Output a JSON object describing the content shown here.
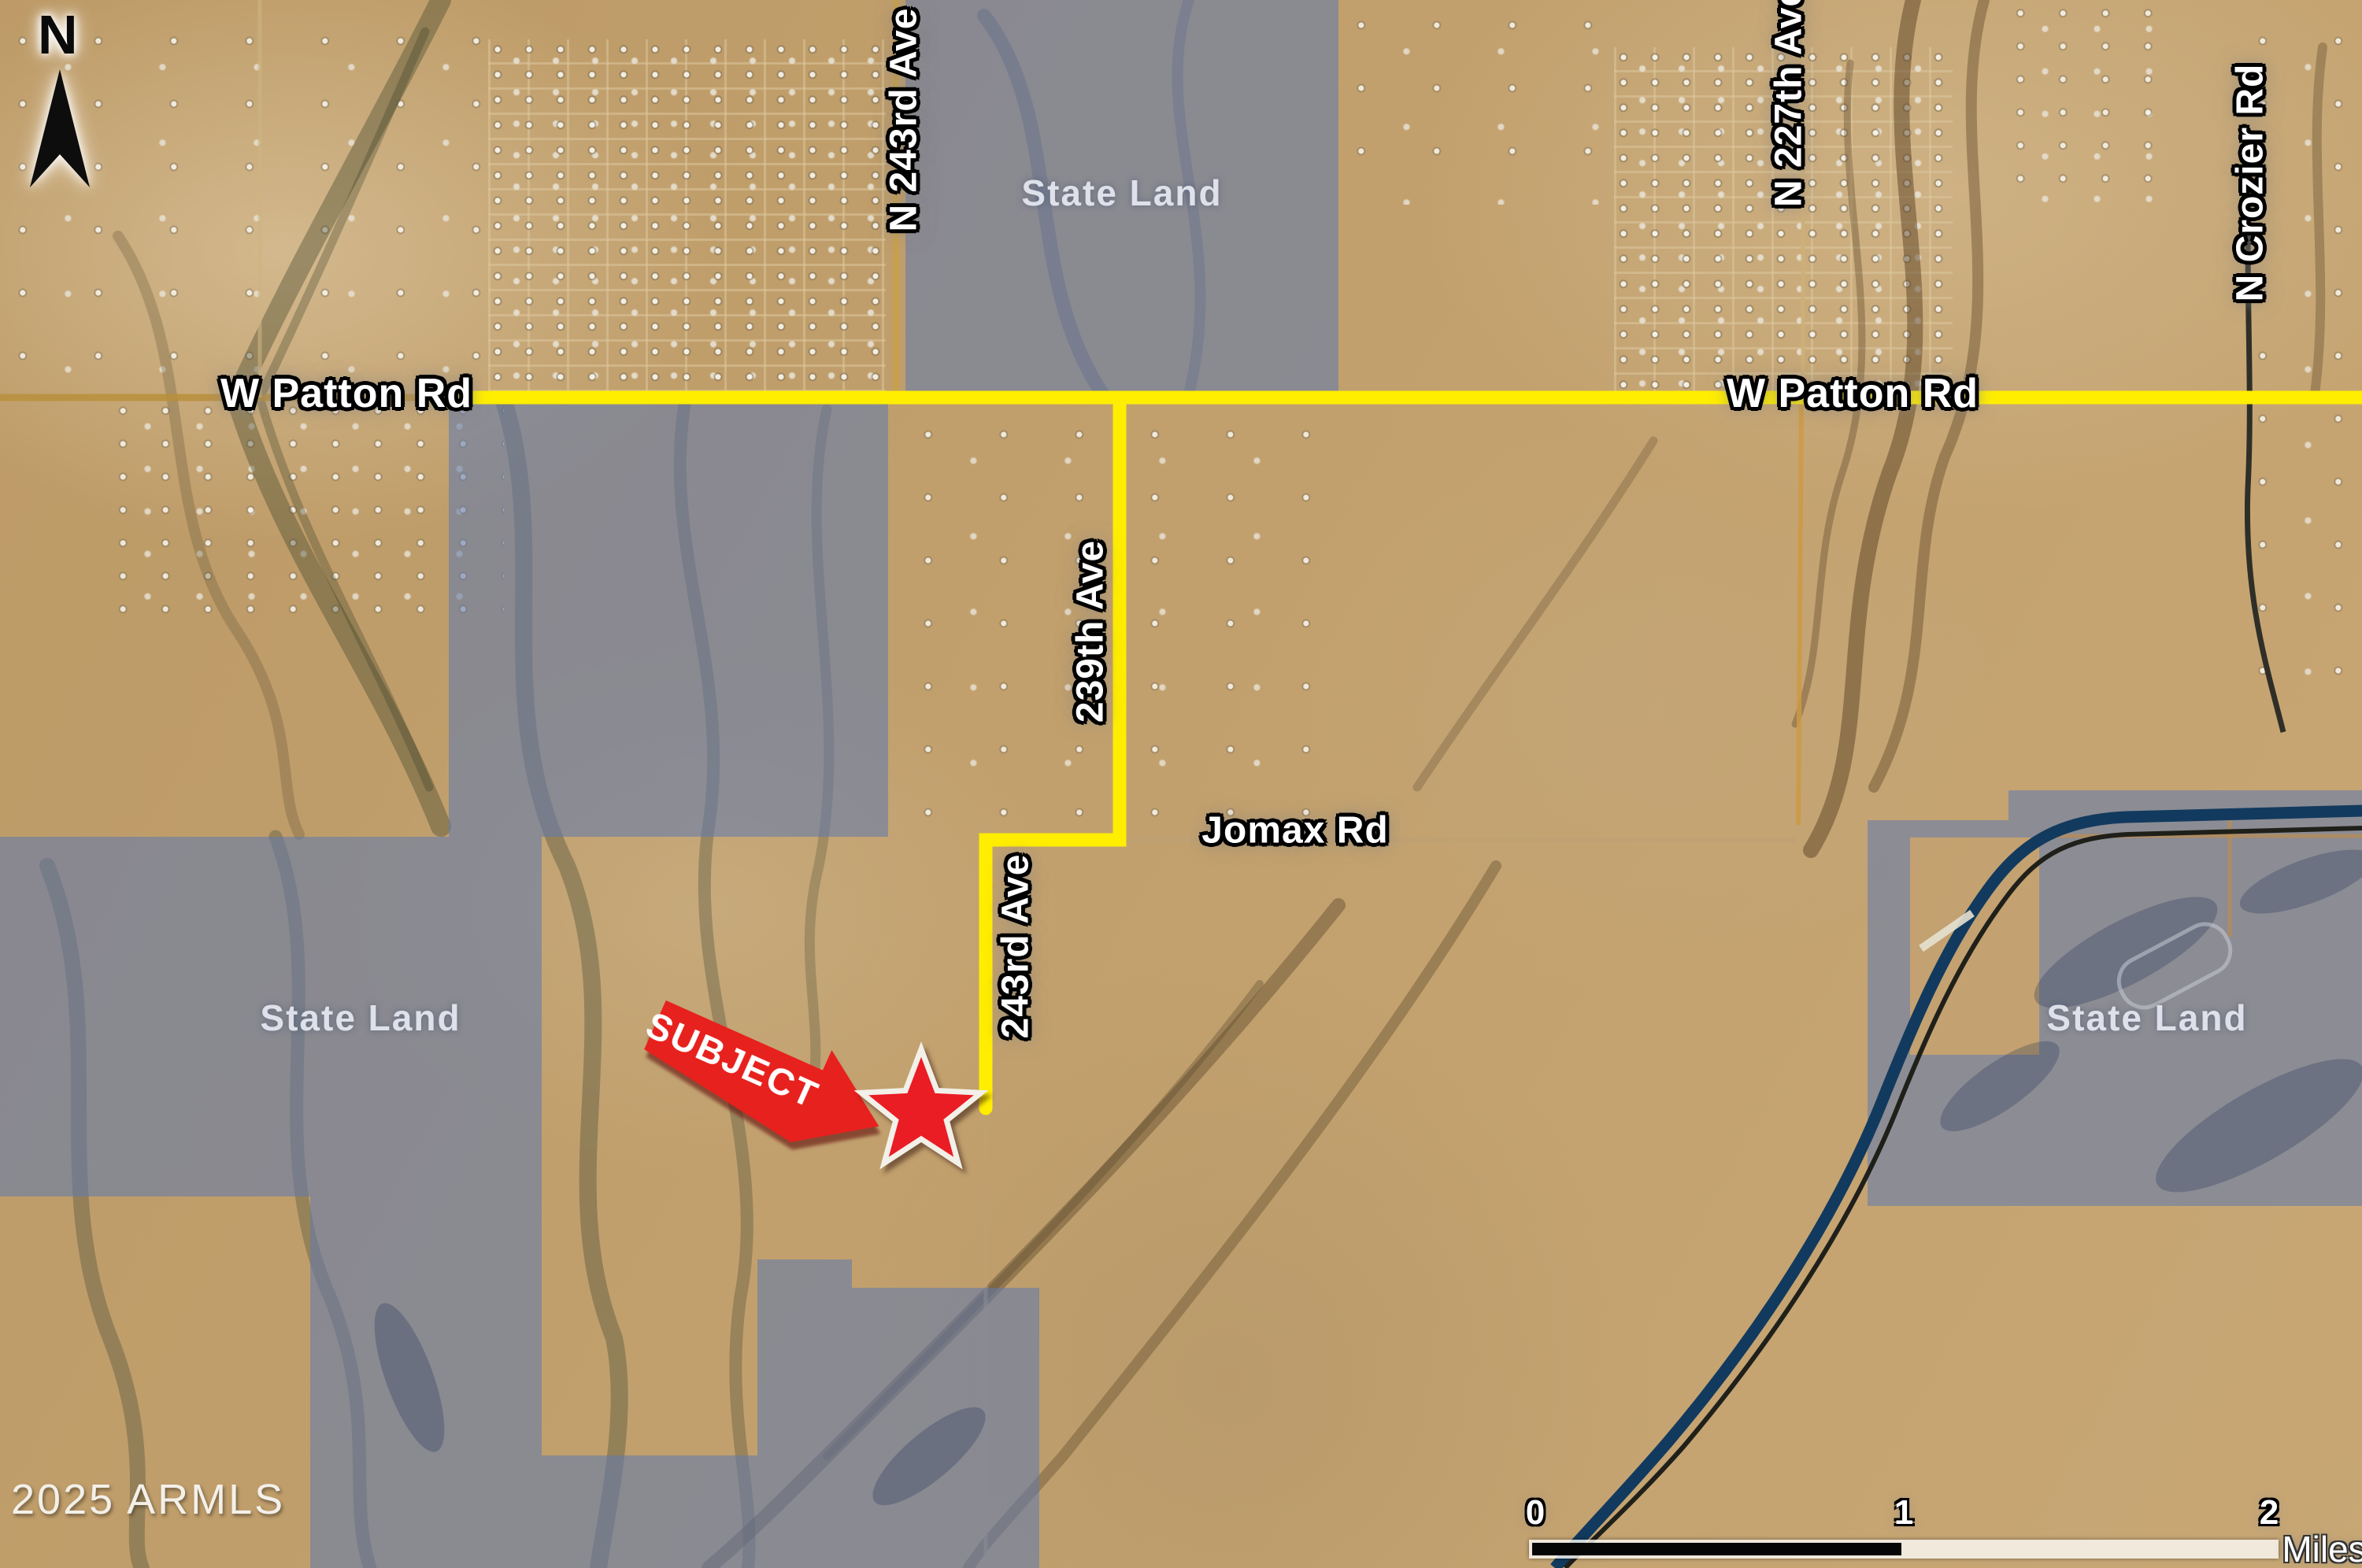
{
  "map": {
    "attribution": "2025 ARMLS",
    "compass": {
      "label": "N"
    },
    "subject": {
      "label": "SUBJECT"
    },
    "state_land_label": "State Land",
    "roads": {
      "patton": "W Patton Rd",
      "ave243_top": "N 243rd Ave",
      "ave227": "N 227th Ave",
      "crozier": "N Crozier Rd",
      "ave239": "239th Ave",
      "jomax": "Jomax Rd",
      "ave243_mid": "243rd Ave"
    },
    "scale": {
      "ticks": [
        "0",
        "1",
        "2"
      ],
      "unit": "Miles"
    },
    "colors": {
      "boundary_yellow": "#ffee00",
      "state_land_overlay": "#627aac",
      "subject_red": "#e7211d",
      "canal_navy": "#123a5e",
      "desert_tan": "#c29e68"
    }
  }
}
